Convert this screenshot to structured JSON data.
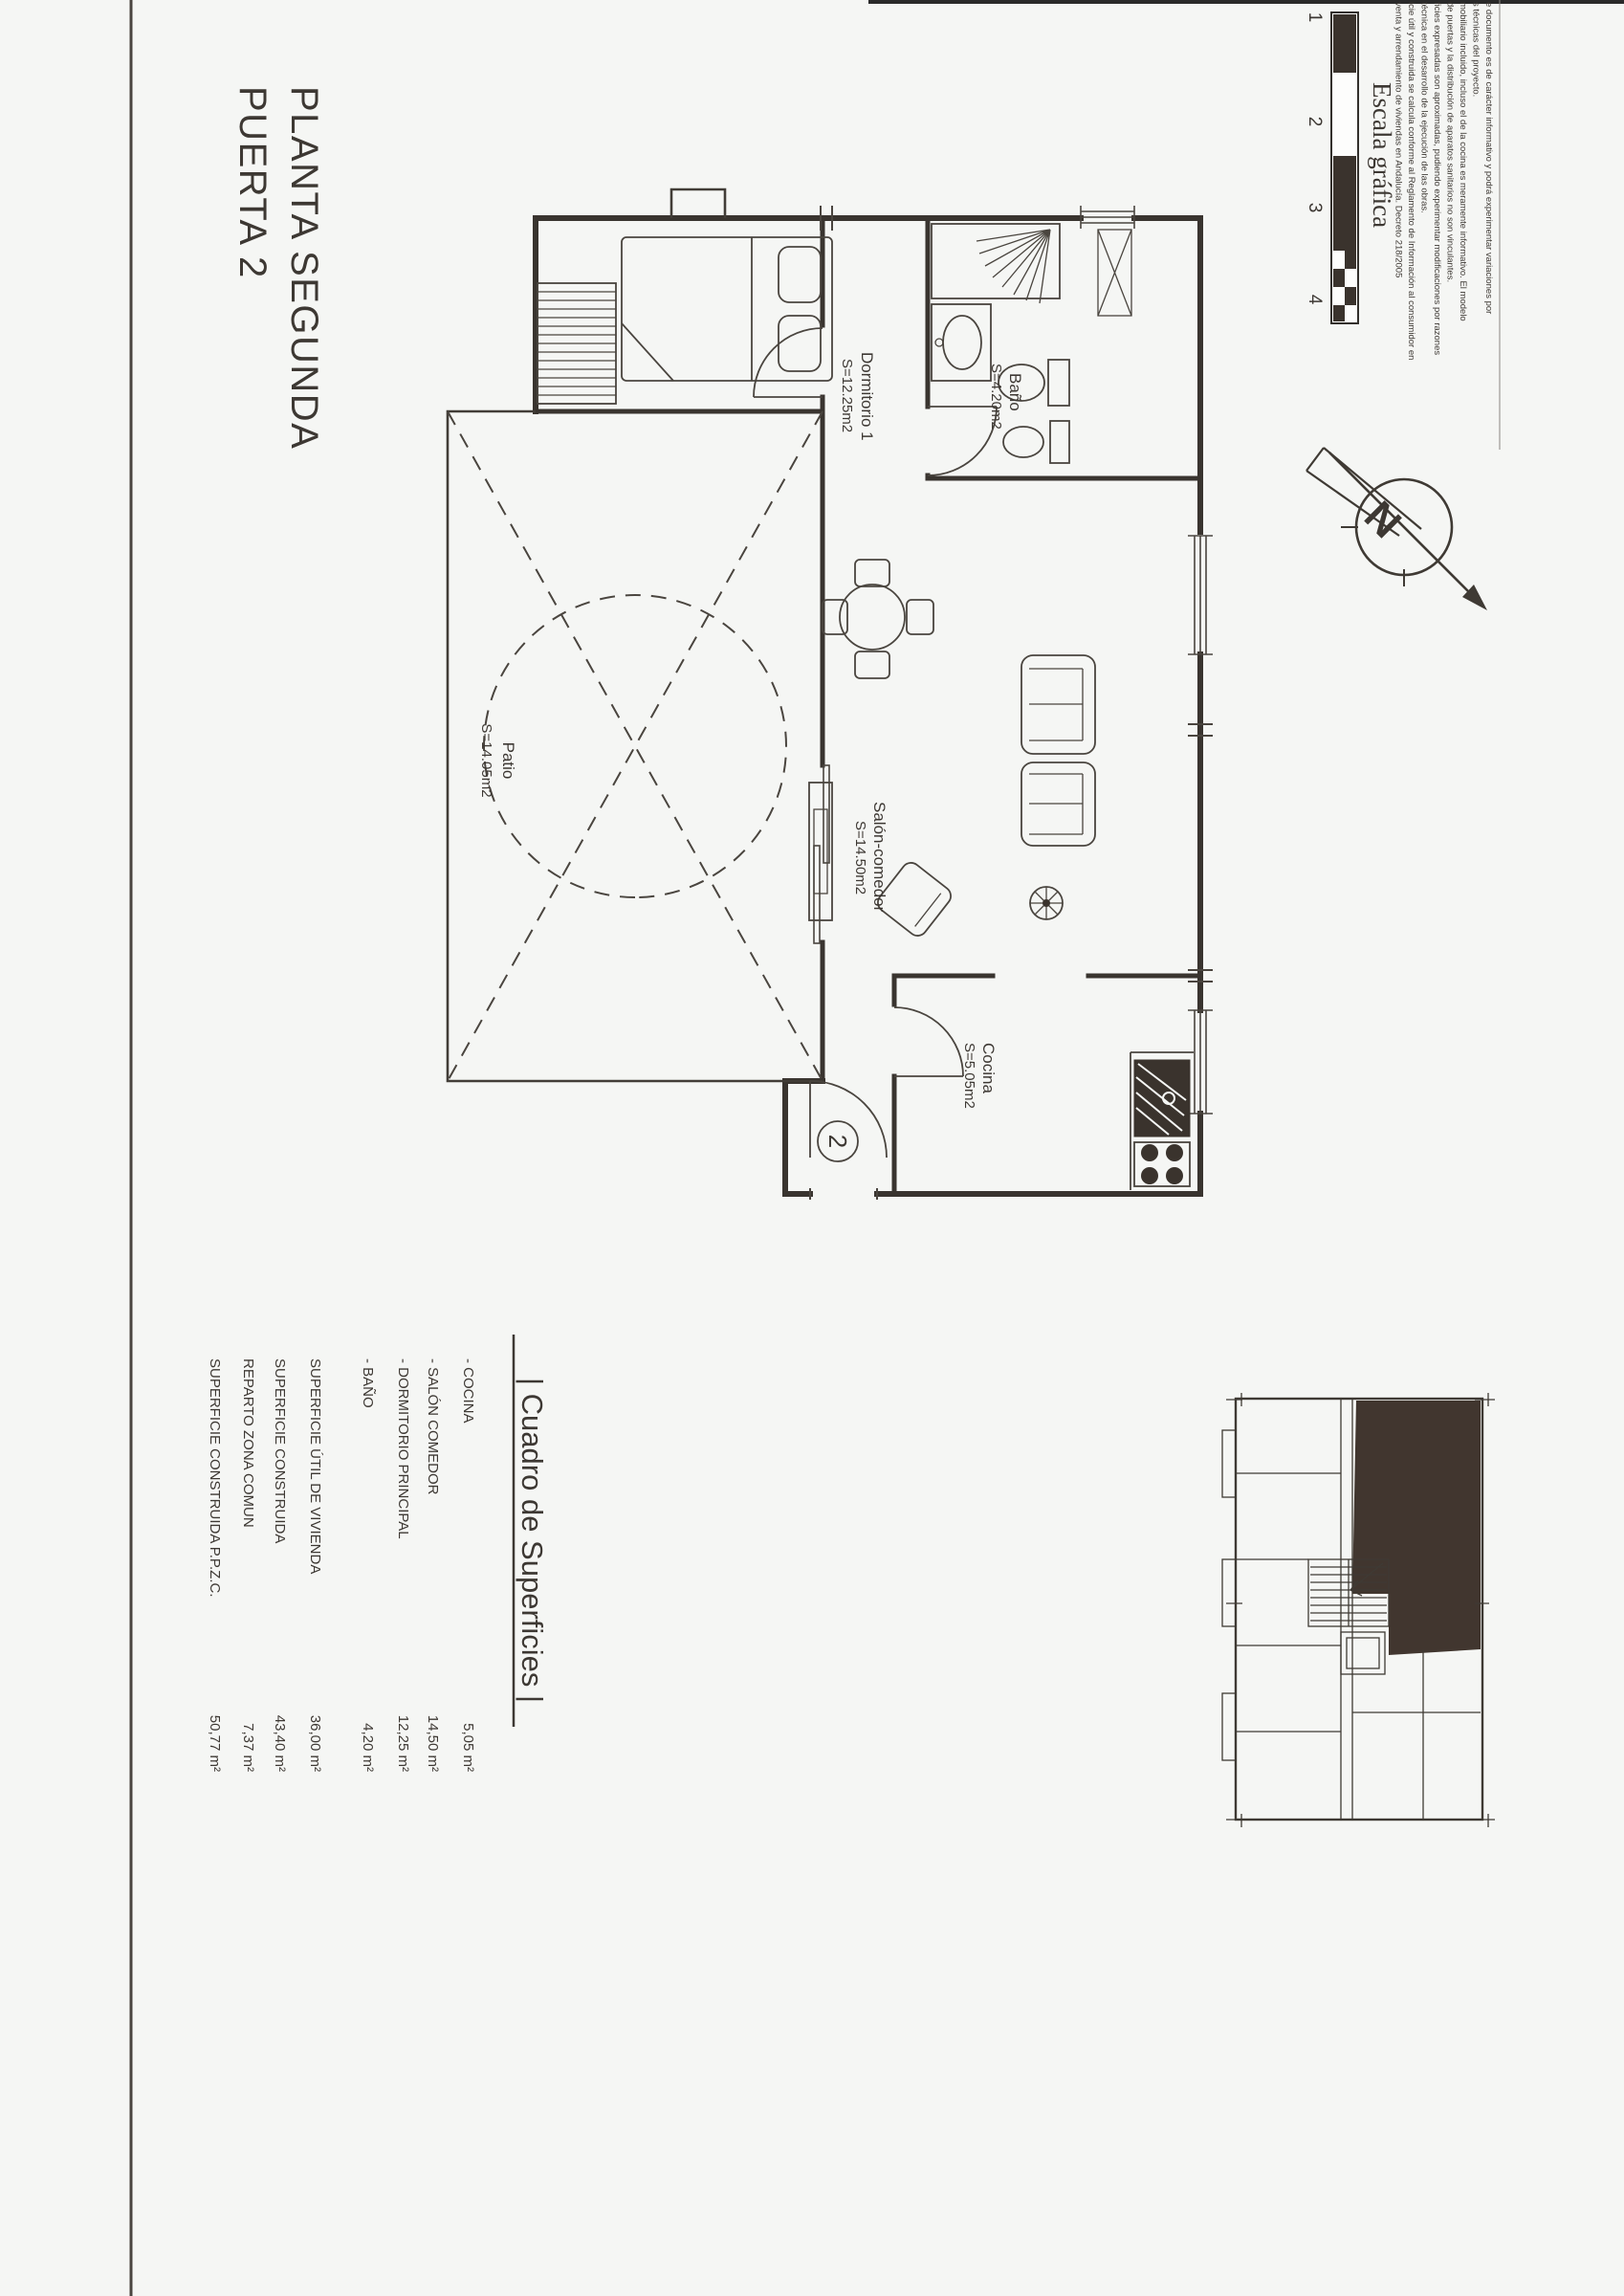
{
  "colors": {
    "ink": "#3d3833",
    "paper": "#f5f6f4",
    "unit_highlight": "#41362f"
  },
  "title": {
    "line1": "PLANTA SEGUNDA",
    "line2": "PUERTA 2"
  },
  "scale_bar": {
    "label": "Escala gráfica",
    "numbers": [
      "1",
      "2",
      "3",
      "4"
    ]
  },
  "disclaimer": {
    "lines": [
      "e documento es de carácter informativo y podrá experimentar variaciones por",
      "s técnicas del proyecto.",
      "mobiliario incluido, incluso el de la cocina es meramente informativo. El modelo",
      "de puertas y la distribución de aparatos sanitarios no son vinculantes.",
      "ficies expresadas son aproximadas, pudiendo experimentar modificaciones por razones",
      "técnica en el desarrollo de la ejecución de las obras.",
      "icie útil y construida se calcula conforme al Reglamento de Información al consumidor en",
      "venta y arrendamiento de viviendas en Andalucía. Decreto 218/2005"
    ]
  },
  "north_arrow": {
    "letter": "N"
  },
  "plan": {
    "door_number": "2",
    "rooms": [
      {
        "name": "Dormitorio 1",
        "area": "S=12.25m2"
      },
      {
        "name": "Baño",
        "area": "S=4.20m2"
      },
      {
        "name": "Salón-comedor",
        "area": "S=14.50m2"
      },
      {
        "name": "Cocina",
        "area": "S=5.05m2"
      },
      {
        "name": "Patio",
        "area": "S=14.05m2"
      }
    ]
  },
  "surfaces_table": {
    "header": "| Cuadro de Superficies |",
    "rows": [
      {
        "label": "- COCINA",
        "value": "5,05 m²"
      },
      {
        "label": "- SALÓN COMEDOR",
        "value": "14,50 m²"
      },
      {
        "label": "- DORMITORIO PRINCIPAL",
        "value": "12,25 m²"
      },
      {
        "label": "- BAÑO",
        "value": "4,20 m²"
      },
      {
        "label": "SUPERFICIE ÚTIL DE VIVIENDA",
        "value": "36,00 m²"
      },
      {
        "label": "SUPERFICIE CONSTRUIDA",
        "value": "43,40 m²"
      },
      {
        "label": "REPARTO ZONA COMUN",
        "value": "7,37 m²"
      },
      {
        "label": "SUPERFICIE CONSTRUIDA P.P.Z.C.",
        "value": "50,77 m²"
      }
    ]
  }
}
